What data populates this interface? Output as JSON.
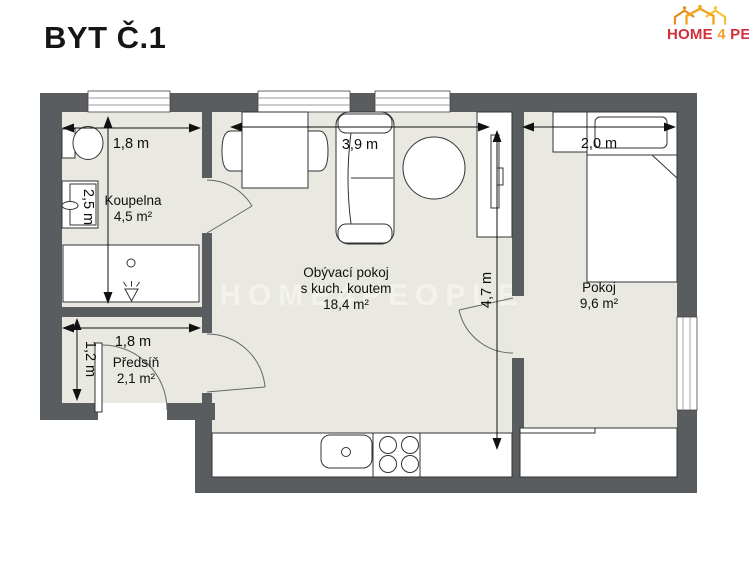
{
  "title": "BYT Č.1",
  "logo": {
    "home": "HOME",
    "four": "4",
    "people": "PEOPLE"
  },
  "watermark": "HOME4PEOPLE",
  "rooms": {
    "koupelna": {
      "name": "Koupelna",
      "area": "4,5 m²"
    },
    "obyvaci": {
      "name": "Obývací pokoj",
      "sub": "s kuch. koutem",
      "area": "18,4 m²"
    },
    "pokoj": {
      "name": "Pokoj",
      "area": "9,6 m²"
    },
    "predsin": {
      "name": "Předsíň",
      "area": "2,1 m²"
    }
  },
  "dims": {
    "koupelna_w": "1,8 m",
    "koupelna_d": "2,5 m",
    "obyvaci_w": "3,9 m",
    "obyvaci_d": "4,7 m",
    "pokoj_w": "2,0 m",
    "predsin_w": "1,8 m",
    "predsin_d": "1,2 m"
  },
  "colors": {
    "wall": "#5a5d60",
    "floor": "#e9e9e1",
    "accent_red": "#d32f3e",
    "accent_orange": "#f0a22e"
  }
}
